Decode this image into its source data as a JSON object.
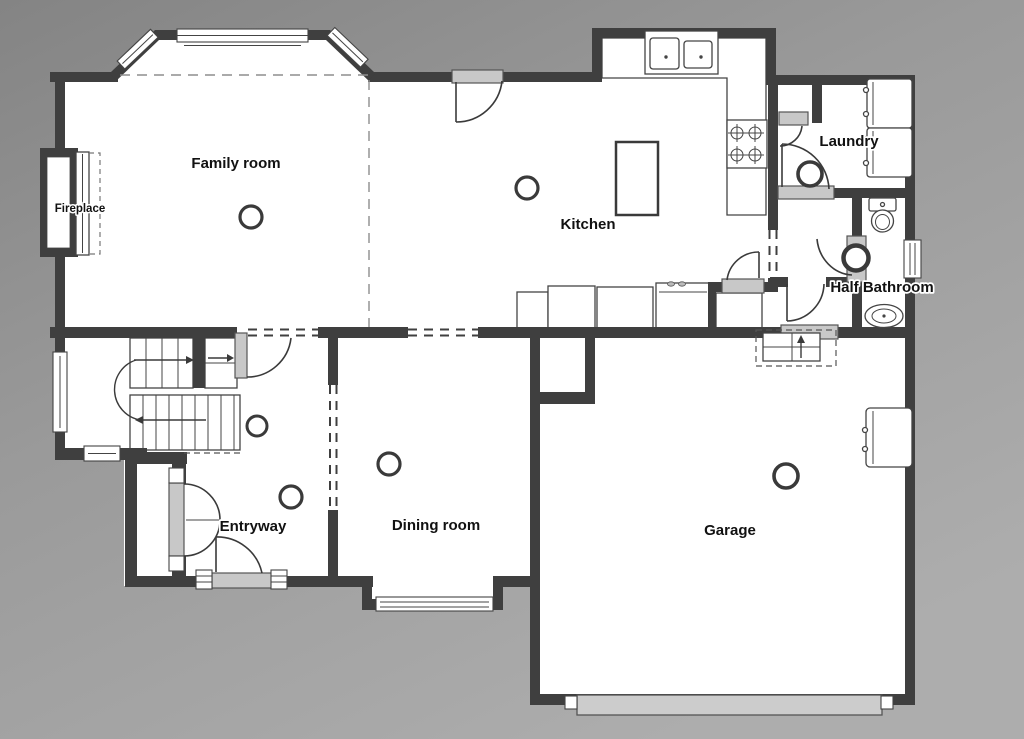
{
  "plan": {
    "kind": "residential-first-floor-plan",
    "rooms": {
      "family_room": {
        "label": "Family room"
      },
      "fireplace": {
        "label": "Fireplace"
      },
      "kitchen": {
        "label": "Kitchen"
      },
      "laundry": {
        "label": "Laundry"
      },
      "half_bathroom": {
        "label": "Half Bathroom"
      },
      "entryway": {
        "label": "Entryway"
      },
      "dining_room": {
        "label": "Dining room"
      },
      "garage": {
        "label": "Garage"
      }
    },
    "symbols": [
      "bay-window",
      "window",
      "door-swing",
      "cased-opening-dashed",
      "ceiling-light",
      "staircase-with-direction-arrows",
      "fireplace-hearth",
      "double-basin-sink",
      "cooktop-4-burner",
      "kitchen-island",
      "counter",
      "pantry-shelf",
      "washer",
      "dryer",
      "toilet",
      "vanity-sink",
      "water-heater",
      "garage-door",
      "garage-entry-steps"
    ],
    "colors": {
      "wall": "#3f3f3f",
      "floor": "#ffffff",
      "door_panel": "#c8c8c8",
      "fixture_line": "#444444",
      "background_dark": "#848484",
      "background_light": "#adadad",
      "label": "#111111",
      "label_halo": "#ffffff"
    }
  }
}
